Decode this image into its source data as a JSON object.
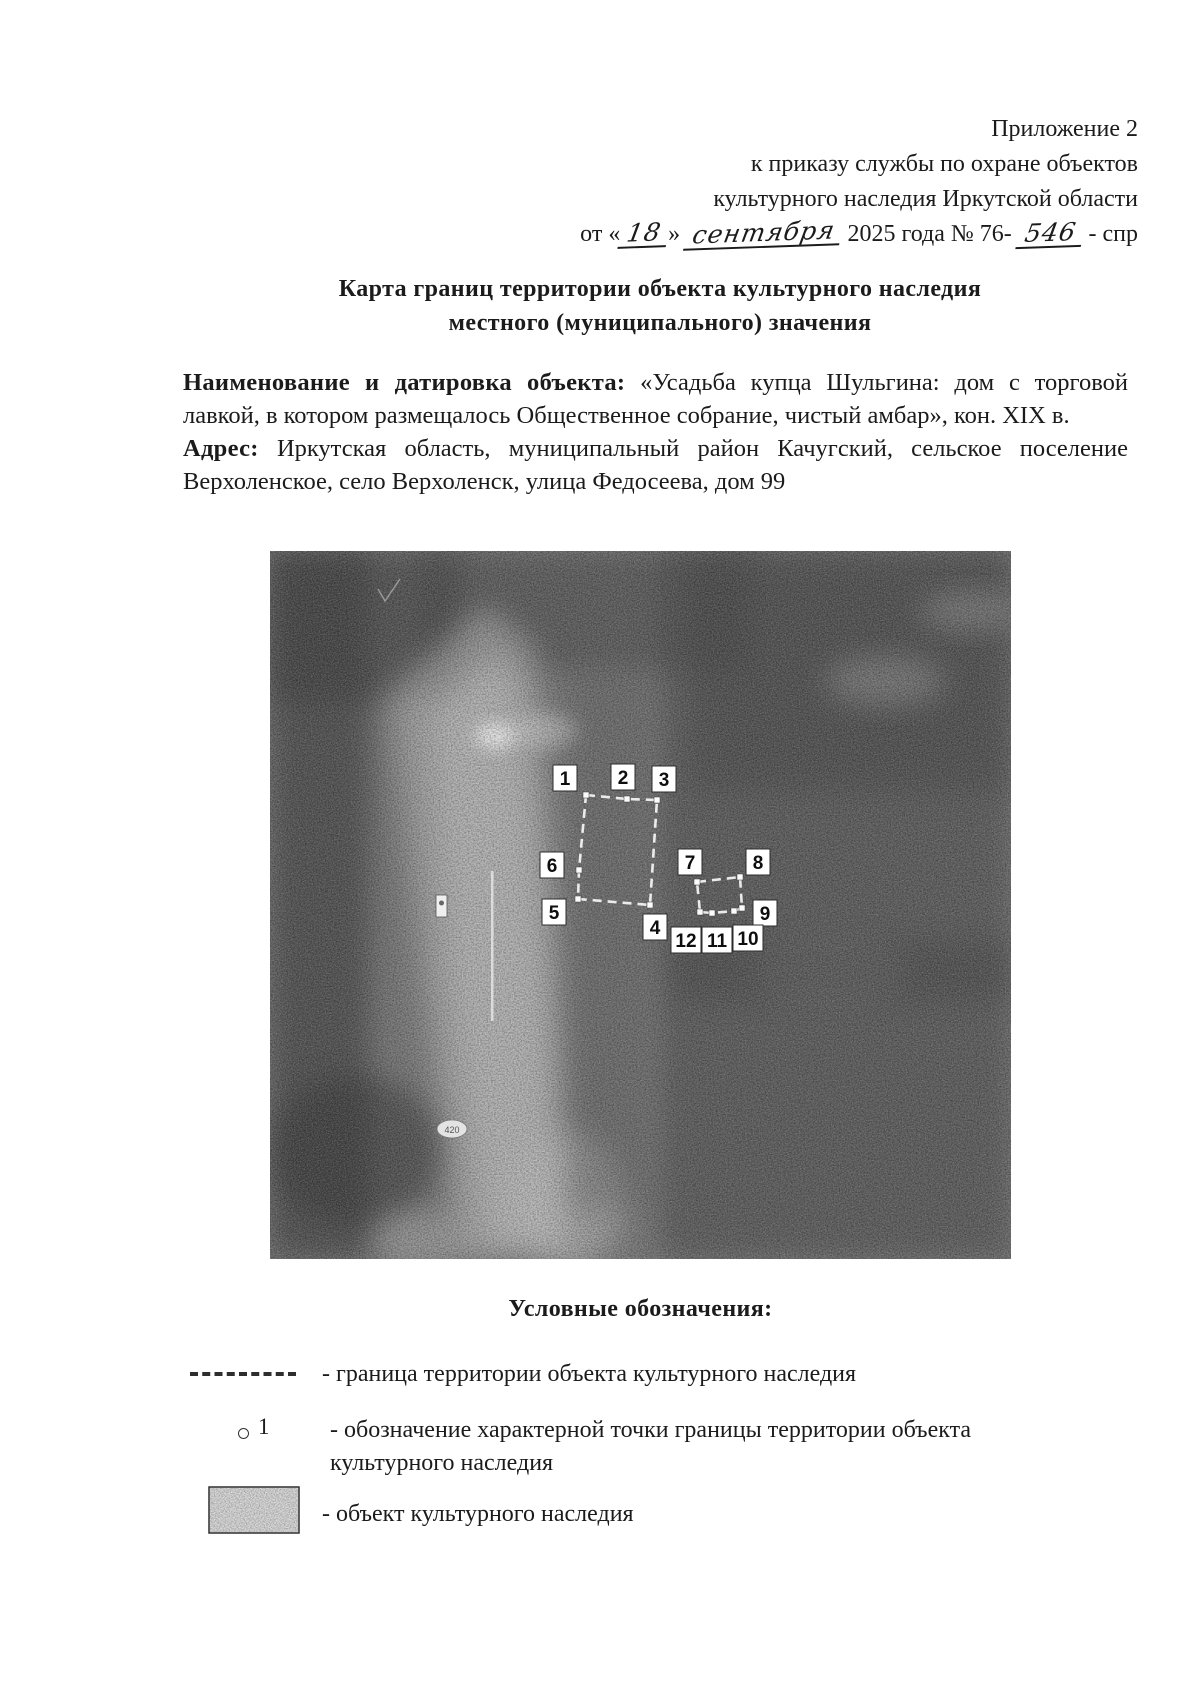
{
  "page": {
    "background": "#ffffff",
    "text_color": "#1b1b1b"
  },
  "header": {
    "line1": "Приложение 2",
    "line2": "к приказу службы по охране объектов",
    "line3": "культурного наследия Иркутской области",
    "date": {
      "prefix": "от «",
      "day": "18",
      "infix": "»",
      "month": "сентября",
      "middle": "2025 года № 76-",
      "number": "546",
      "suffix": "- спр"
    }
  },
  "title": {
    "line1": "Карта границ территории объекта культурного наследия",
    "line2": "местного (муниципального) значения"
  },
  "object_paragraph": {
    "label": "Наименование и датировка объекта:",
    "text": "«Усадьба купца Шульгина: дом с торговой лавкой, в котором размещалось Общественное собрание, чистый амбар», кон. XIX в."
  },
  "address_paragraph": {
    "label": "Адрес:",
    "text": "Иркутская область, муниципальный район Качугский, сельское поселение Верхоленское, село Верхоленск, улица Федосеева, дом 99"
  },
  "map": {
    "points": [
      "1",
      "2",
      "3",
      "4",
      "5",
      "6",
      "7",
      "8",
      "9",
      "10",
      "11",
      "12"
    ],
    "small_sign": "420",
    "base_color": "#787878",
    "boundary_color": "#f2f2f2",
    "marker_bg": "#ffffff",
    "marker_text_color": "#0e0e0e"
  },
  "legend": {
    "title": "Условные обозначения:",
    "items": [
      {
        "symbol": "dashed-line",
        "text": "- граница территории объекта культурного наследия"
      },
      {
        "symbol": "point-marker",
        "marker_label": "1",
        "text": "- обозначение характерной точки границы территории объекта культурного наследия"
      },
      {
        "symbol": "stippled-rect",
        "text": "- объект культурного наследия"
      }
    ]
  }
}
